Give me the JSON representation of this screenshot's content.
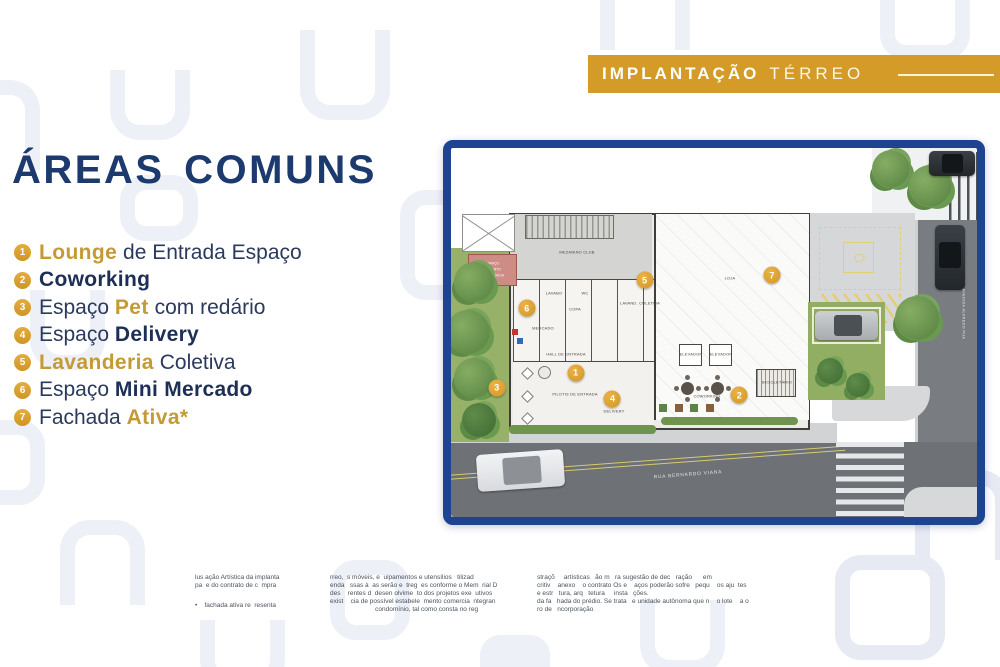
{
  "colors": {
    "navy": "#1c3a6e",
    "gold_banner": "#d49b28",
    "gold_text": "#c49a35",
    "plan_border": "#1e4491",
    "street_gray": "#6e7175",
    "grass_green": "#97b169"
  },
  "banner": {
    "word1": "IMPLANTAÇÃO",
    "word2": "TÉRREO"
  },
  "areas": {
    "title": "ÁREAS COMUNS",
    "items": [
      {
        "num": "1",
        "segments": [
          {
            "text": "Lounge",
            "style": "gold"
          },
          {
            "text": " de Entrada Espaço",
            "style": "navy"
          }
        ]
      },
      {
        "num": "2",
        "segments": [
          {
            "text": "Coworking",
            "style": "navy-bold"
          }
        ]
      },
      {
        "num": "3",
        "segments": [
          {
            "text": "Espaço ",
            "style": "navy"
          },
          {
            "text": "Pet",
            "style": "gold"
          },
          {
            "text": " com redário",
            "style": "navy"
          }
        ]
      },
      {
        "num": "4",
        "segments": [
          {
            "text": "Espaço ",
            "style": "navy"
          },
          {
            "text": "Delivery",
            "style": "navy-bold"
          }
        ]
      },
      {
        "num": "5",
        "segments": [
          {
            "text": "Lavanderia",
            "style": "gold"
          },
          {
            "text": " Coletiva",
            "style": "navy"
          }
        ]
      },
      {
        "num": "6",
        "segments": [
          {
            "text": "Espaço ",
            "style": "navy"
          },
          {
            "text": "Mini Mercado",
            "style": "navy-bold"
          }
        ]
      },
      {
        "num": "7",
        "segments": [
          {
            "text": "Fachada ",
            "style": "navy"
          },
          {
            "text": "Ativa*",
            "style": "gold"
          }
        ]
      }
    ]
  },
  "plan": {
    "markers": [
      "1",
      "2",
      "3",
      "4",
      "5",
      "6",
      "7"
    ],
    "labels": {
      "mezanino": "MEZANINO CLUB",
      "loja": "LOJA",
      "lavabo": "LAVABO",
      "wc": "WC",
      "copa": "COPA",
      "lavanderia": "LAVAND. COLETIVA",
      "mercado": "MERCADO",
      "hall": "HALL DE ENTRADA",
      "pilotis": "PILOTIS DE ENTRADA",
      "delivery": "DELIVERY",
      "elevador1": "ELEVADOR",
      "elevador2": "ELEVADOR",
      "coworking": "COWORKING",
      "bicicletario": "BICICLETÁRIO",
      "pergola1": "ESPAÇO",
      "pergola2": "COBERTO",
      "pergola3": "CONVIVÊNCIA",
      "rua": "RUA BERNARDO VIANA",
      "avenida": "AVENIDA ALFREDO PUA"
    }
  },
  "disclaimer": {
    "col1": [
      "lus ação Artística da implanta",
      "pa  e do contrato de c  mpra",
      "•    fachada ativa re  resenta"
    ],
    "col2": [
      "rreo,  s móveis, e  uipamentos e utensílios   tilizad",
      "enda   ssas à  as serão e  treg  es conforme o Mem  rial D",
      "des    rentes d  desen olvime  to dos projetos exe  utivos",
      "exist    cia de possível estabele  mento comercia  ntegran",
      "                         condomínio, tal como consta no reg"
    ],
    "col3": [
      "straçõ     artísticas   ão m   ra sugestão de dec   ração      em",
      "critiv    anexo    o contrato Os e    aços poderão sofre   pequ    os aju  tes",
      "e estr   tura, arq   tetura     insta   ções.",
      "da fa   hada do prédio. Se trata   e unidade autônoma que n    o lote    a o",
      "ro de   ncorporação"
    ]
  }
}
